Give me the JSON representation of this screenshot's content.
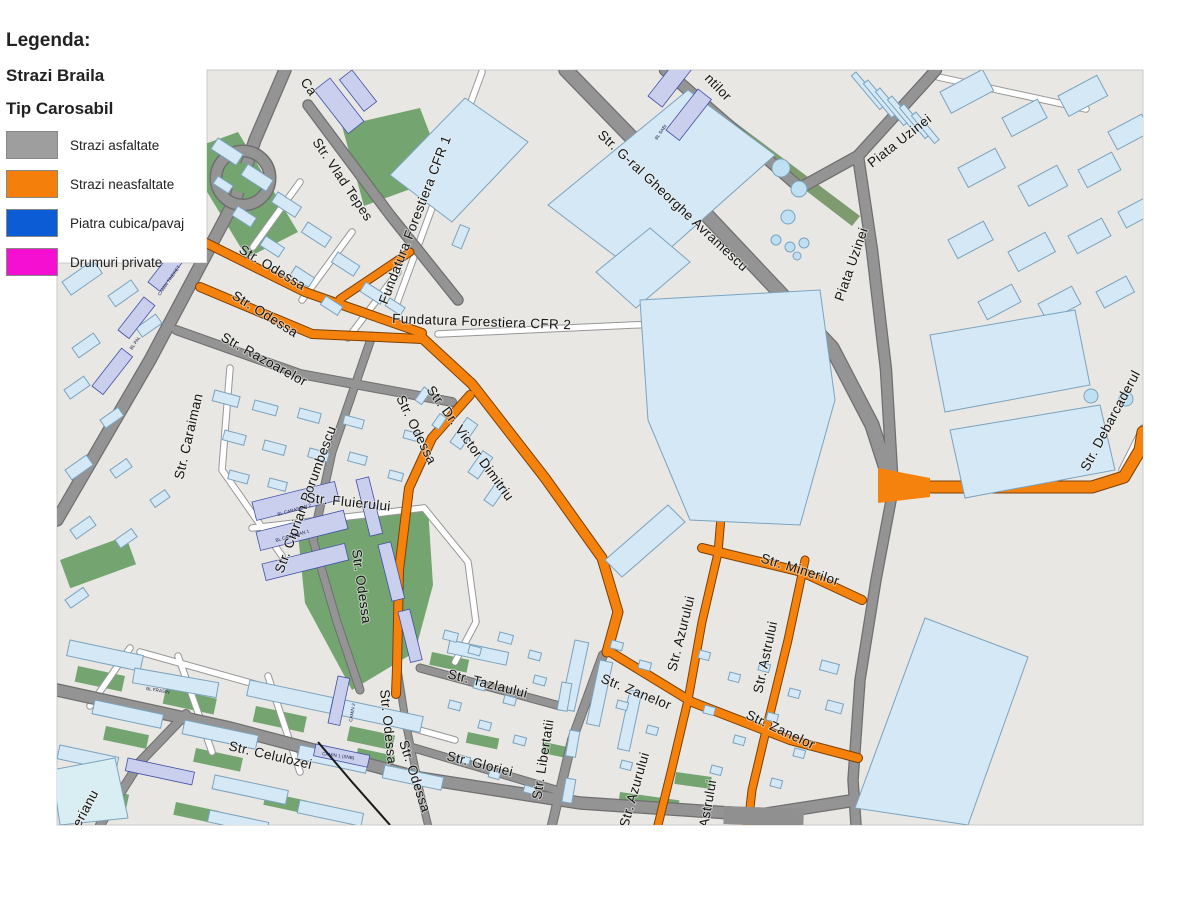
{
  "legend": {
    "title": "Legenda:",
    "subtitle": "Strazi Braila",
    "section": "Tip Carosabil",
    "items": [
      {
        "label": "Strazi asfaltate",
        "color": "#9e9e9e"
      },
      {
        "label": "Strazi neasfaltate",
        "color": "#f57f0b"
      },
      {
        "label": "Piatra cubica/pavaj",
        "color": "#0b5cd5"
      },
      {
        "label": "Drumuri private",
        "color": "#f50fd0"
      }
    ]
  },
  "map": {
    "colors": {
      "background": "#e8e7e3",
      "asphalt_road": "#949494",
      "unpaved_road": "#f5820d",
      "building": "#d5e8f5",
      "building_block": "#c9cfec",
      "green_area": "#74a571",
      "railway": "#1a1a1a"
    },
    "street_labels": [
      {
        "id": "ca",
        "text": "Ca"
      },
      {
        "id": "vlad-tepes",
        "text": "Str. Vlad Tepes"
      },
      {
        "id": "fundatura-cfr1",
        "text": "Fundatura Forestiera CFR 1"
      },
      {
        "id": "fundatura-cfr2",
        "text": "Fundatura Forestiera CFR 2"
      },
      {
        "id": "avramescu",
        "text": "Str. G-ral Gheorghe Avramescu"
      },
      {
        "id": "ntilor",
        "text": "ntilor"
      },
      {
        "id": "piata-uzinei-a",
        "text": "Piata Uzinei"
      },
      {
        "id": "piata-uzinei-b",
        "text": "Piata Uzinei"
      },
      {
        "id": "odessa-a",
        "text": "Str. Odessa"
      },
      {
        "id": "odessa-b",
        "text": "Str. Odessa"
      },
      {
        "id": "razoarelor",
        "text": "Str. Razoarelor"
      },
      {
        "id": "caraiman",
        "text": "Str. Caraiman"
      },
      {
        "id": "ciprian",
        "text": "Str. Ciprian Porumbescu"
      },
      {
        "id": "odessa-c",
        "text": "Str. Odessa"
      },
      {
        "id": "dimitriu",
        "text": "Str. Dr. Victor Dimitriu"
      },
      {
        "id": "fluierului",
        "text": "Str. Fluierului"
      },
      {
        "id": "odessa-d",
        "text": "Str. Odessa"
      },
      {
        "id": "minerilor",
        "text": "Str. Minerilor"
      },
      {
        "id": "debarcaderului",
        "text": "Str. Debarcaderul"
      },
      {
        "id": "tazlaului",
        "text": "Str. Tazlaului"
      },
      {
        "id": "zanelor-a",
        "text": "Str. Zanelor"
      },
      {
        "id": "zanelor-b",
        "text": "Str. Zanelor"
      },
      {
        "id": "azurului-a",
        "text": "Str. Azurului"
      },
      {
        "id": "azurului-b",
        "text": "Str. Azurului"
      },
      {
        "id": "astrului-a",
        "text": "Str. Astrului"
      },
      {
        "id": "astrului-b",
        "text": "Astrului"
      },
      {
        "id": "libertatii",
        "text": "Str. Libertatii"
      },
      {
        "id": "gloriei",
        "text": "Str. Gloriei"
      },
      {
        "id": "celulozei",
        "text": "Str. Celulozei"
      },
      {
        "id": "odessa-e",
        "text": "Str. Odessa"
      },
      {
        "id": "odessa-f",
        "text": "Str. Odessa"
      },
      {
        "id": "erianu",
        "text": "erianu"
      }
    ],
    "building_labels": [
      {
        "id": "bl-frasin",
        "text": "BL FRASIN"
      },
      {
        "id": "camin-2",
        "text": "CAMIN 2"
      },
      {
        "id": "camin-1-snb",
        "text": "CAMIN 1 (SNB)"
      },
      {
        "id": "bl-caraiman-1",
        "text": "BL CARAIMAN 1"
      },
      {
        "id": "bl-caraiman-2",
        "text": "BL CARAIMAN 2"
      },
      {
        "id": "camin-tineret",
        "text": "CAMIN TINERET"
      },
      {
        "id": "bl-pal",
        "text": "BL PAL"
      },
      {
        "id": "bl-sabi",
        "text": "BL SABI"
      }
    ]
  }
}
